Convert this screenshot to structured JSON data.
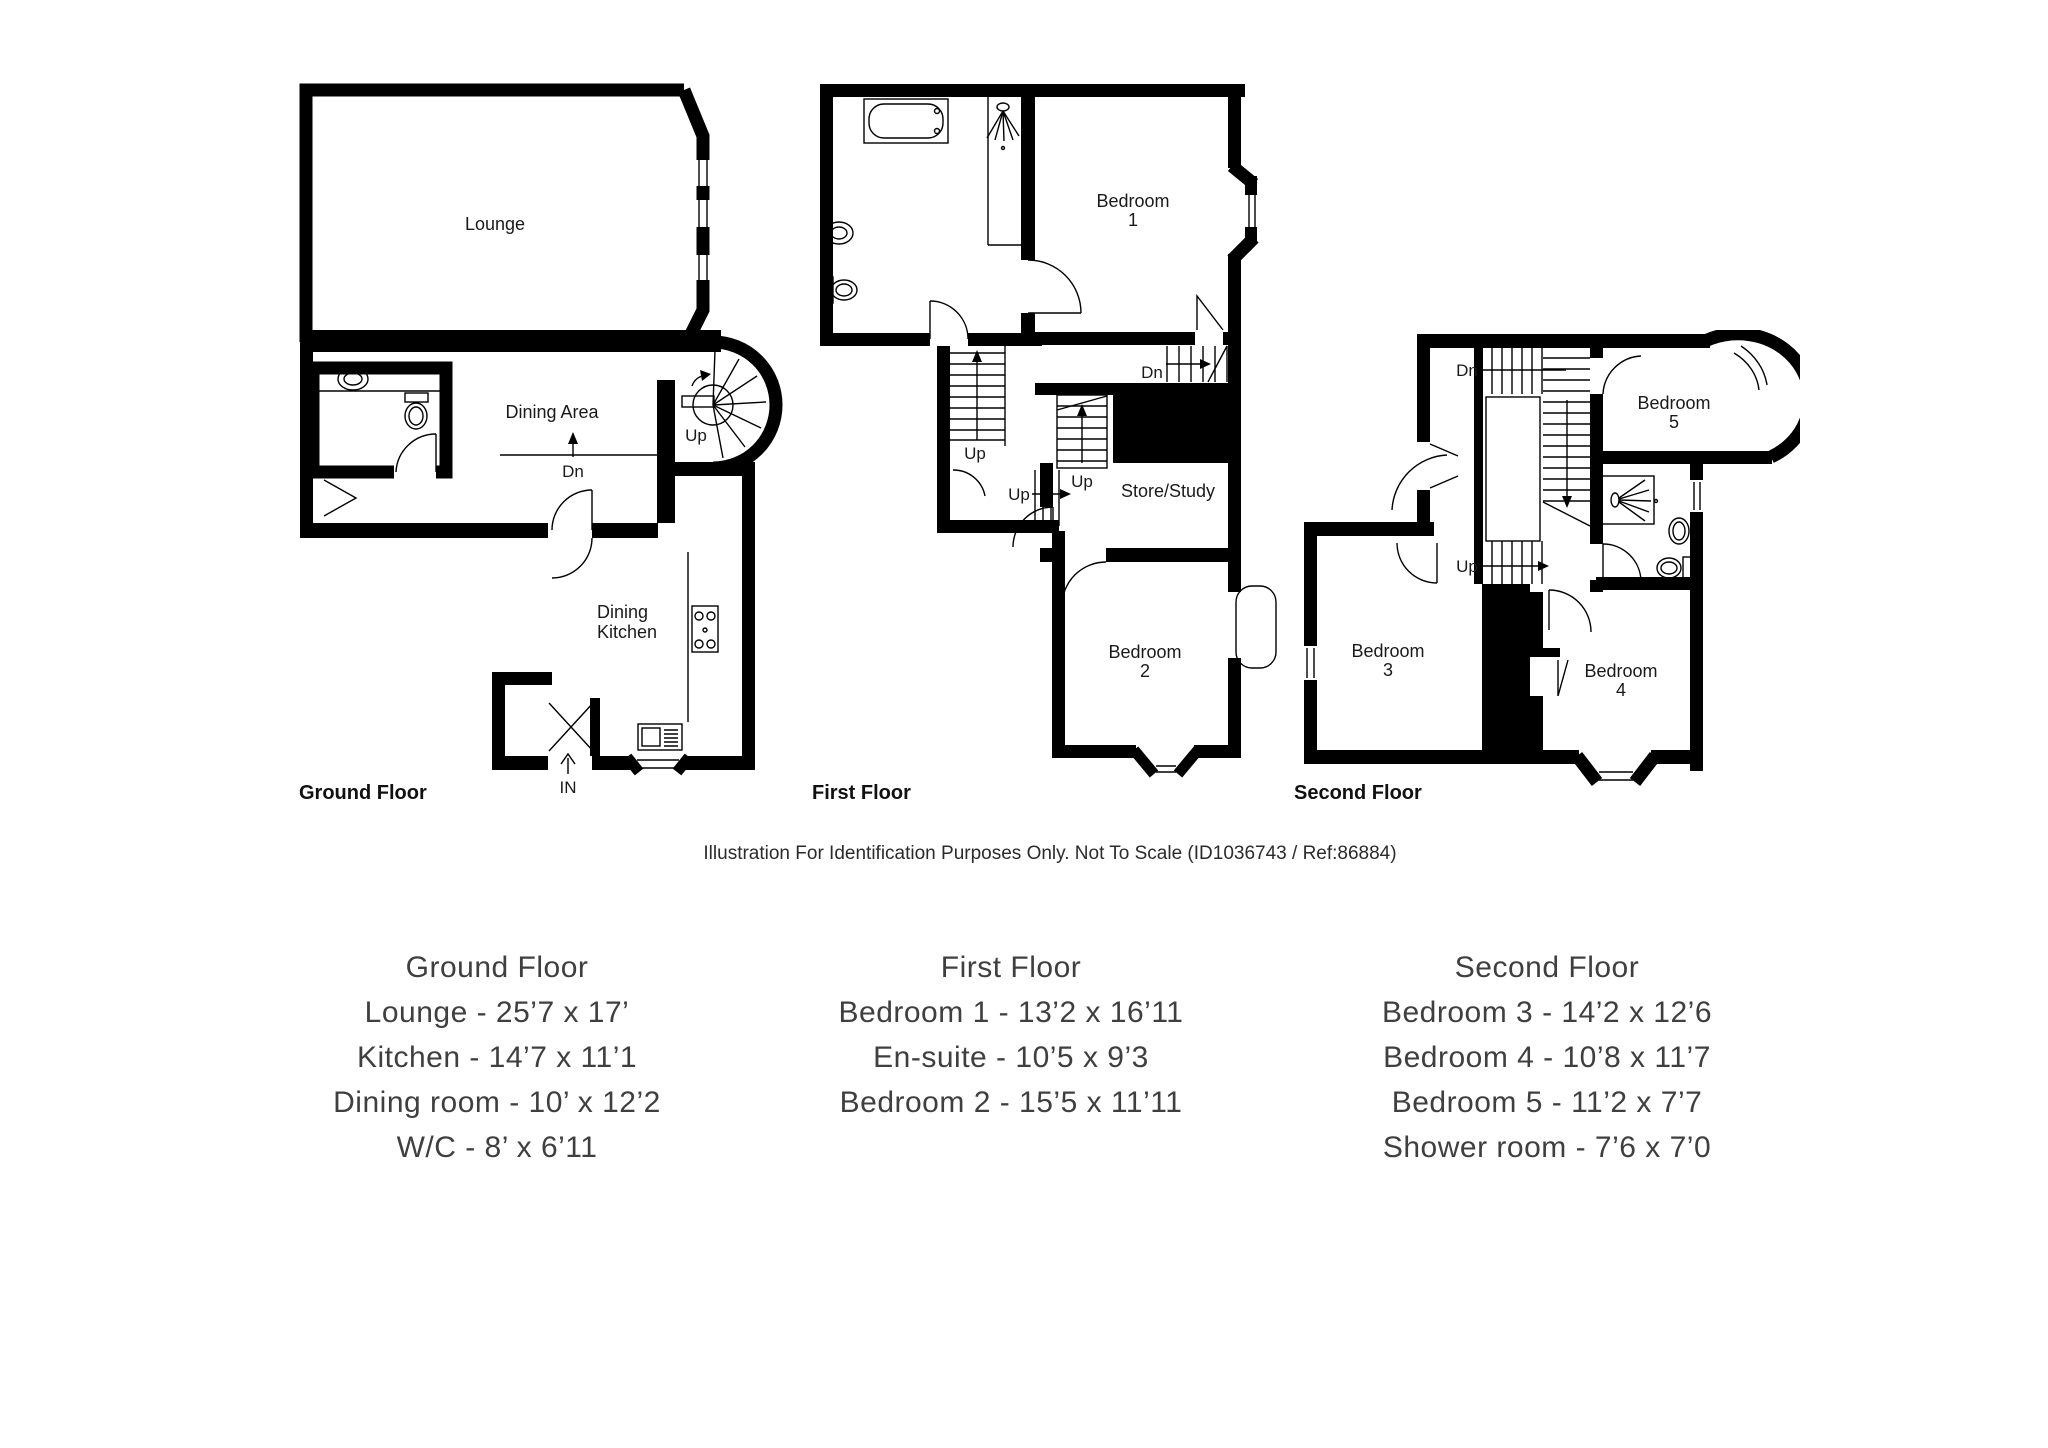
{
  "page": {
    "background": "#ffffff"
  },
  "disclaimer": "Illustration For Identification Purposes Only. Not To Scale (ID1036743 / Ref:86884)",
  "plans": {
    "ground": {
      "caption": "Ground Floor",
      "labels": {
        "lounge": "Lounge",
        "dining_area": "Dining Area",
        "dining_kitchen": [
          "Dining",
          "Kitchen"
        ],
        "up": "Up",
        "dn": "Dn",
        "entrance": "IN"
      }
    },
    "first": {
      "caption": "First Floor",
      "labels": {
        "bedroom1": [
          "Bedroom",
          "1"
        ],
        "bedroom2": [
          "Bedroom",
          "2"
        ],
        "store": "Store/Study",
        "dn": "Dn",
        "up_main": "Up",
        "up_mid": "Up",
        "up_small": "Up"
      }
    },
    "second": {
      "caption": "Second Floor",
      "labels": {
        "bedroom3": [
          "Bedroom",
          "3"
        ],
        "bedroom4": [
          "Bedroom",
          "4"
        ],
        "bedroom5": [
          "Bedroom",
          "5"
        ],
        "dn": "Dn",
        "up": "Up"
      }
    }
  },
  "summaries": [
    {
      "heading": "Ground Floor",
      "lines": [
        "Lounge - 25’7 x 17’",
        "Kitchen - 14’7 x 11’1",
        "Dining room - 10’ x 12’2",
        "W/C - 8’ x 6’11"
      ]
    },
    {
      "heading": "First Floor",
      "lines": [
        "Bedroom 1 - 13’2 x 16’11",
        "En-suite - 10’5 x 9’3",
        "Bedroom 2 - 15’5 x 11’11"
      ]
    },
    {
      "heading": "Second Floor",
      "lines": [
        "Bedroom 3 - 14’2 x 12’6",
        "Bedroom 4 - 10’8 x 11’7",
        "Bedroom 5 - 11’2 x 7’7",
        "Shower room - 7’6 x 7’0"
      ]
    }
  ]
}
